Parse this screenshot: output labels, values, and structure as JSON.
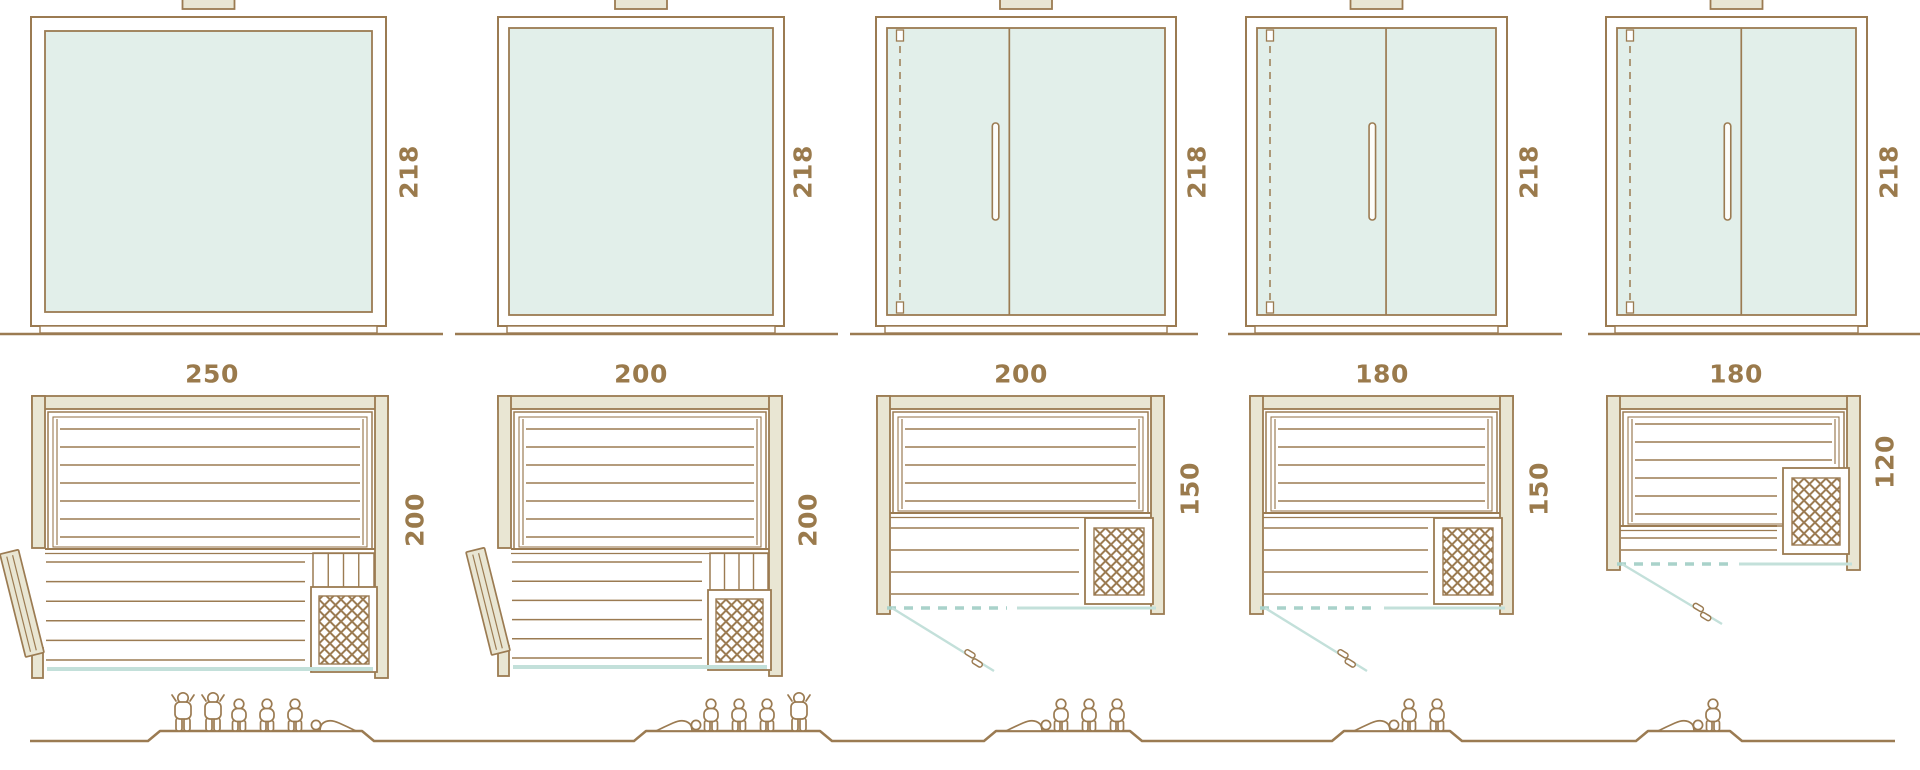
{
  "diagram": {
    "description": "Sauna model size comparison: front elevations, floor plans and capacity figures",
    "colors": {
      "outline": "#9b7b52",
      "wall_fill": "#e9e6d3",
      "glass_fill": "#e2efea",
      "teal_solid": "#c3e0da",
      "teal_dashed": "#a9d2ca",
      "label_text": "#9a7a4c",
      "white": "#ffffff"
    },
    "models": [
      {
        "front_width": "250",
        "front_height": "218",
        "plan_depth": "200",
        "front_type": "fixed-glass-front",
        "plan_type": "side-hinged-door",
        "capacity_icons": [
          "person-standing",
          "person-standing",
          "person-seated",
          "person-seated",
          "person-seated",
          "person-lying"
        ]
      },
      {
        "front_width": "200",
        "front_height": "218",
        "plan_depth": "200",
        "front_type": "fixed-glass-front",
        "plan_type": "side-hinged-door",
        "capacity_icons": [
          "person-lying",
          "person-seated",
          "person-seated",
          "person-seated",
          "person-standing"
        ]
      },
      {
        "front_width": "200",
        "front_height": "218",
        "plan_depth": "150",
        "front_type": "glass-door-front",
        "plan_type": "front-glass-door",
        "capacity_icons": [
          "person-lying",
          "person-seated",
          "person-seated",
          "person-seated"
        ]
      },
      {
        "front_width": "180",
        "front_height": "218",
        "plan_depth": "150",
        "front_type": "glass-door-front",
        "plan_type": "front-glass-door",
        "capacity_icons": [
          "person-lying",
          "person-seated",
          "person-seated"
        ]
      },
      {
        "front_width": "180",
        "front_height": "218",
        "plan_depth": "120",
        "front_type": "glass-door-front",
        "plan_type": "front-glass-door",
        "capacity_icons": [
          "person-lying",
          "person-seated"
        ]
      }
    ]
  }
}
